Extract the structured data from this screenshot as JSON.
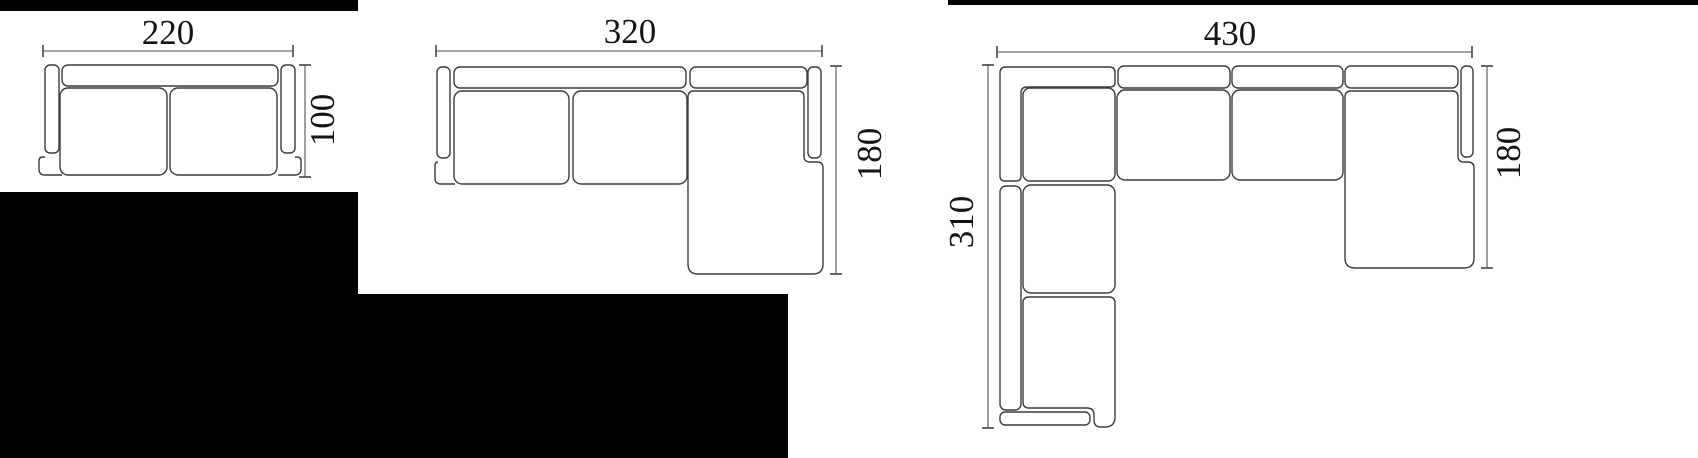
{
  "figure_type": "sofa dimension plan drawings",
  "sofas": [
    {
      "name": "two-seat sofa top view",
      "width": "220",
      "depth": "100"
    },
    {
      "name": "chaise sofa top view",
      "width": "320",
      "depth": "180"
    },
    {
      "name": "corner sofa top view",
      "width": "430",
      "left_depth": "310",
      "right_depth": "180"
    }
  ],
  "colors": {
    "outline": "#3c3c3c",
    "dimension_line": "#6e6e6e",
    "tick": "#444444",
    "label": "#141414",
    "mask": "#000000",
    "background": "#ffffff"
  }
}
